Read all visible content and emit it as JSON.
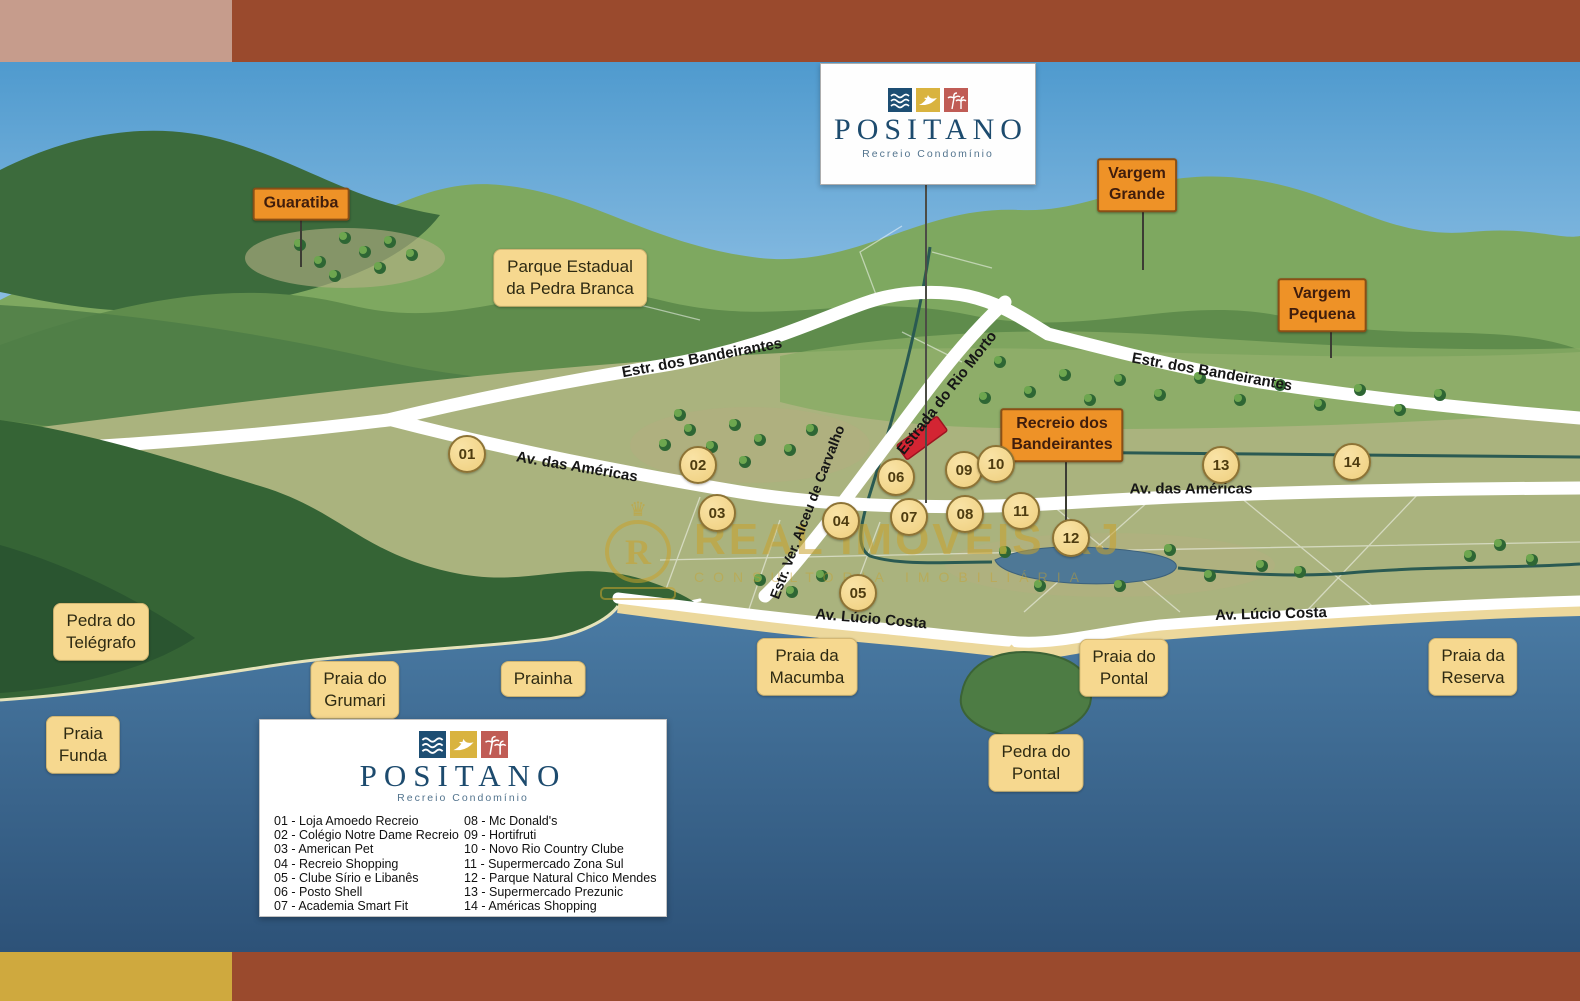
{
  "sign": {
    "title": "POSITANO",
    "subtitle": "Recreio Condomínio"
  },
  "legend": {
    "title": "POSITANO",
    "subtitle": "Recreio Condomínio",
    "items_left": [
      "01 - Loja Amoedo Recreio",
      "02 - Colégio Notre Dame Recreio",
      "03 - American Pet",
      "04 - Recreio Shopping",
      "05 - Clube Sírio e Libanês",
      "06 - Posto Shell",
      "07 - Academia Smart Fit"
    ],
    "items_right": [
      "08 - Mc Donald's",
      "09 - Hortifruti",
      "10 - Novo Rio Country Clube",
      "11 - Supermercado Zona Sul",
      "12 - Parque Natural Chico Mendes",
      "13 - Supermercado Prezunic",
      "14 - Américas Shopping"
    ]
  },
  "map": {
    "places_yellow": {
      "parque_pedra_branca": "Parque Estadual\nda Pedra Branca",
      "pedra_do_telegrafo": "Pedra do\nTelégrafo",
      "praia_funda": "Praia\nFunda",
      "praia_do_grumari": "Praia do\nGrumari",
      "prainha": "Prainha",
      "praia_da_macumba": "Praia da\nMacumba",
      "praia_do_pontal": "Praia do\nPontal",
      "pedra_do_pontal": "Pedra do\nPontal",
      "praia_da_reserva": "Praia da\nReserva"
    },
    "places_orange": {
      "guaratiba": "Guaratiba",
      "vargem_grande": "Vargem\nGrande",
      "vargem_pequena": "Vargem\nPequena",
      "recreio": "Recreio dos\nBandeirantes"
    },
    "roads": {
      "bandeirantes_left": "Estr. dos Bandeirantes",
      "bandeirantes_right": "Estr. dos Bandeirantes",
      "rio_morto": "Estrada do Rio Morto",
      "americas_left": "Av. das Américas",
      "americas_right": "Av. das Américas",
      "alceu": "Estr. Ver. Alceu de Carvalho",
      "lucio_left": "Av. Lúcio Costa",
      "lucio_right": "Av. Lúcio Costa"
    },
    "markers": [
      "01",
      "02",
      "03",
      "04",
      "05",
      "06",
      "07",
      "08",
      "09",
      "10",
      "11",
      "12",
      "13",
      "14"
    ],
    "watermark": {
      "initial": "R",
      "line1": "REAL IMÓVEIS RJ",
      "line2": "CONSULTORIA IMOBILIÁRIA"
    }
  },
  "colors": {
    "frame_brown": "#9a4a2d",
    "frame_pink": "#c69c8c",
    "frame_gold": "#cfa93e",
    "label_yellow": "#f6d88f",
    "label_orange": "#ee9227",
    "marker_fill": "#efcf7e",
    "site_red": "#d32533",
    "brand_navy": "#1d4b6e",
    "water": "#3a6890"
  }
}
